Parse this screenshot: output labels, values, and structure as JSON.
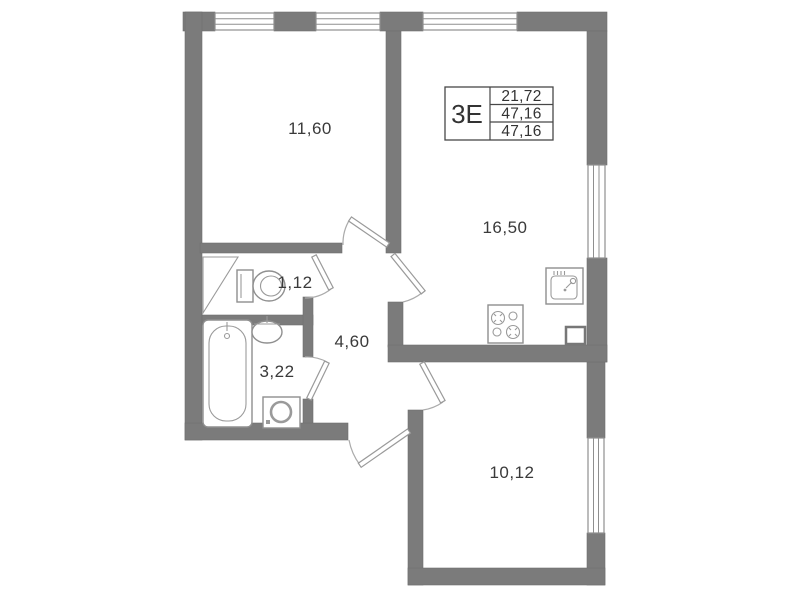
{
  "plan": {
    "background_color": "#ffffff",
    "wall_color": "#7b7b7b",
    "line_color": "#9a9a9a",
    "text_color": "#3a3a3a"
  },
  "stamp": {
    "unit_type": "3Е",
    "rows": [
      "21,72",
      "47,16",
      "47,16"
    ]
  },
  "rooms": {
    "bedroom": {
      "area": "11,60"
    },
    "kitchen_living": {
      "area": "16,50"
    },
    "wc": {
      "area": "1,12"
    },
    "hallway": {
      "area": "4,60"
    },
    "bathroom": {
      "area": "3,22"
    },
    "bedroom_2": {
      "area": "10,12"
    }
  }
}
